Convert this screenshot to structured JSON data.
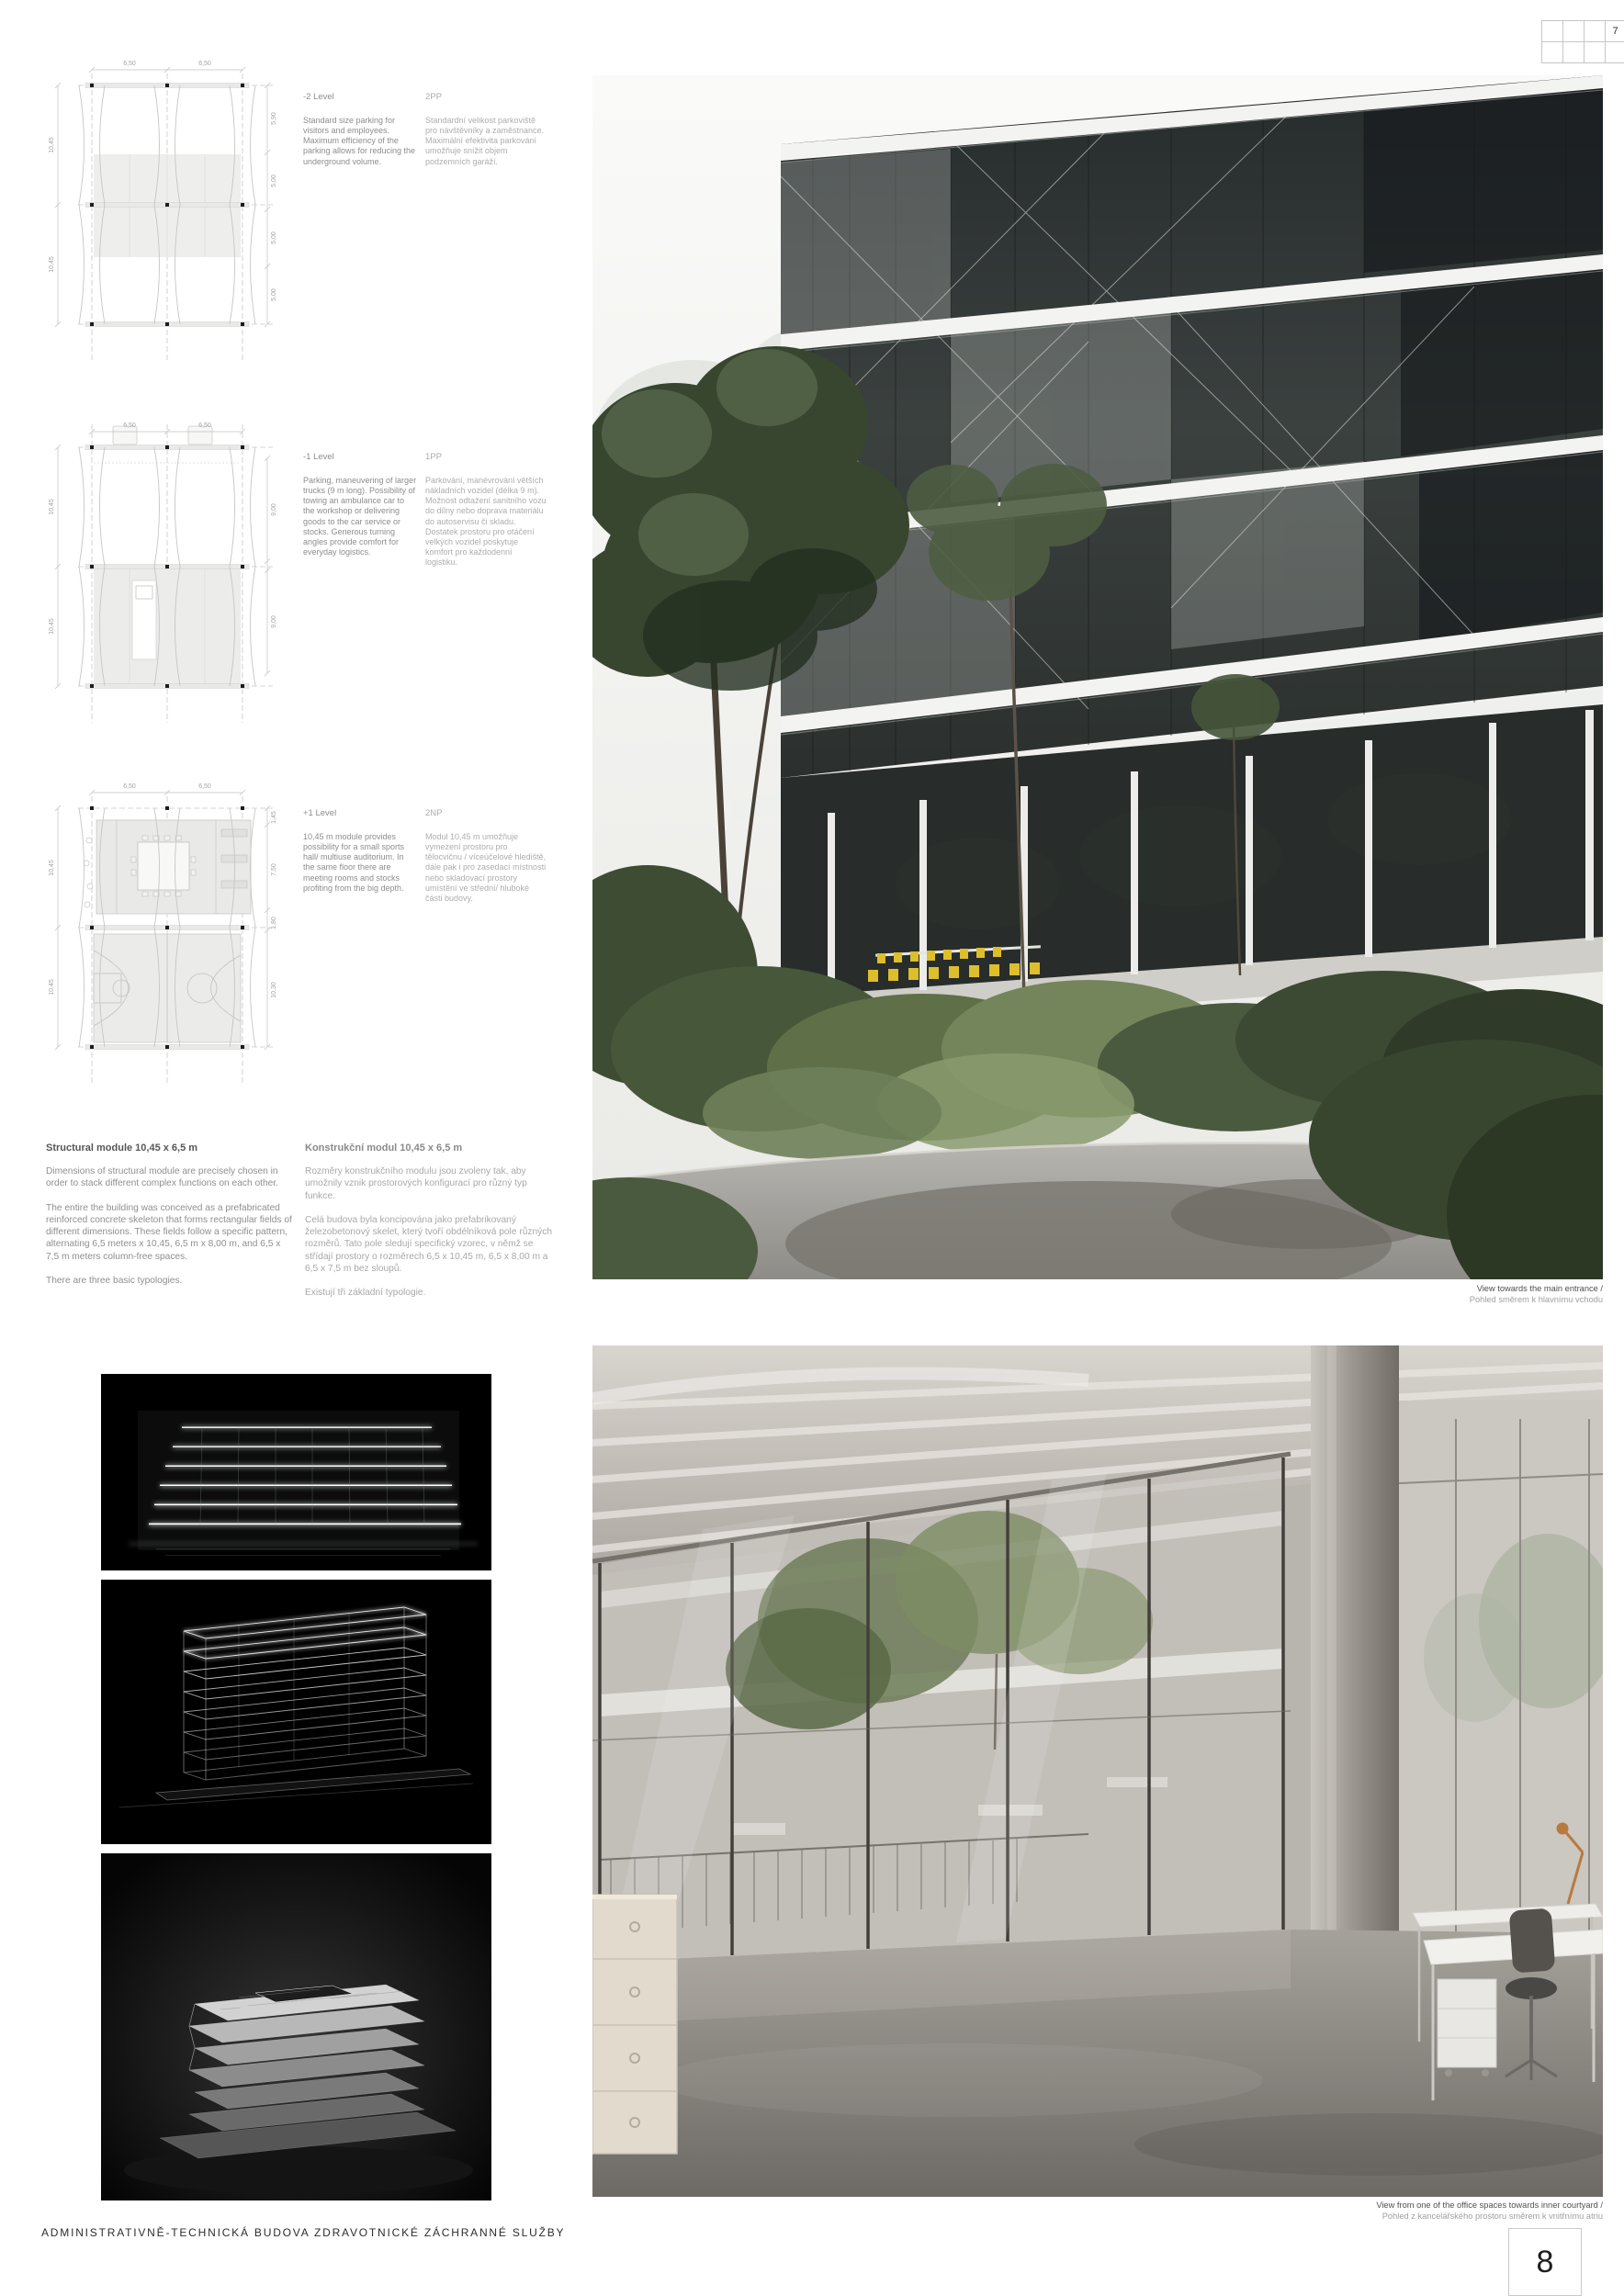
{
  "page": {
    "title": "ADMINISTRATIVNĚ-TECHNICKÁ BUDOVA ZDRAVOTNICKÉ ZÁCHRANNÉ SLUŽBY",
    "page_number": "8",
    "sheet_index": "7"
  },
  "levels": [
    {
      "name_en": "-2 Level",
      "name_cz": "2PP",
      "text_en": "Standard size parking for visitors and employees. Maximum efficiency of the parking allows for reducing the underground volume.",
      "text_cz": "Standardní velikost parkoviště pro návštěvníky a zaměstnance. Maximální efektivita parkování umožňuje snížit objem podzemních garáží.",
      "dims": {
        "top": [
          "6,50",
          "6,50"
        ],
        "left": [
          "10,45",
          "10,45"
        ],
        "right": [
          "5,90",
          "5,00",
          "5,00",
          "5,00"
        ]
      }
    },
    {
      "name_en": "-1 Level",
      "name_cz": "1PP",
      "text_en": "Parking, maneuvering of larger trucks (9 m long). Possibility of towing an ambulance car to the workshop or delivering goods to the car service or stocks. Generous turning angles provide comfort for everyday logistics.",
      "text_cz": "Parkování, manévrování větších nákladních vozidel (délka 9 m). Možnost odtažení sanitního vozu do dílny nebo doprava materiálu do autoservisu či skladu. Dostatek prostoru pro otáčení velkých vozidel poskytuje komfort pro každodenní logistiku.",
      "dims": {
        "top": [
          "6,50",
          "6,50"
        ],
        "left": [
          "10,45",
          "10,45"
        ],
        "right": [
          "9,00",
          "9,00"
        ]
      }
    },
    {
      "name_en": "+1 Level",
      "name_cz": "2NP",
      "text_en": "10,45 m module provides possibility for a small sports hall/ multiuse auditorium. In the same floor there are meeting rooms and stocks profiting from the big depth.",
      "text_cz": "Modul 10,45 m umožňuje vymezení prostoru pro tělocvičnu / víceúčelové hlediště, dále pak i pro zasedací místnosti nebo skladovací prostory umístění ve střední/ hluboké části budovy.",
      "dims": {
        "top": [
          "6,50",
          "6,50"
        ],
        "left": [
          "10,45",
          "10,45"
        ],
        "right": [
          "1,45",
          "7,50",
          "1,80",
          "10,30"
        ]
      }
    }
  ],
  "structural": {
    "heading_en": "Structural module 10,45 x 6,5 m",
    "heading_cz": "Konstrukční modul 10,45 x 6,5 m",
    "paragraphs_en": [
      "Dimensions of structural module are precisely chosen in order to stack different complex functions on each other.",
      "The entire the building was conceived as a prefabricated reinforced concrete skeleton that forms rectangular fields of different dimensions. These fields follow a specific pattern, alternating 6,5 meters x 10,45, 6,5 m x 8,00 m, and 6,5 x 7,5 m meters column-free spaces.",
      "There are three basic typologies."
    ],
    "paragraphs_cz": [
      "Rozměry konstrukčního modulu jsou zvoleny tak, aby umožnily vznik prostorových konfigurací pro různý typ funkce.",
      "Celá budova byla koncipována jako prefabrikovaný železobetonový skelet, který tvoří obdélníková pole různých rozměrů. Tato pole sledují specifický vzorec, v němž se střídají prostory o rozměrech 6,5 x 10,45 m, 6,5 x 8,00 m a 6,5 x 7,5 m bez sloupů.",
      "Existují tři základní typologie."
    ]
  },
  "captions": {
    "exterior_en": "View towards the main entrance /",
    "exterior_cz": "Pohled směrem k hlavnímu vchodu",
    "interior_en": "View from one of the office spaces towards inner courtyard /",
    "interior_cz": "Pohled z kancelářského prostoru směrem k vnitřnímu atriu"
  },
  "colors": {
    "accent_yellow_chairs": "#ddbe2c",
    "plan_line": "#c6c6c6",
    "dim_text": "#a3a3a3"
  }
}
